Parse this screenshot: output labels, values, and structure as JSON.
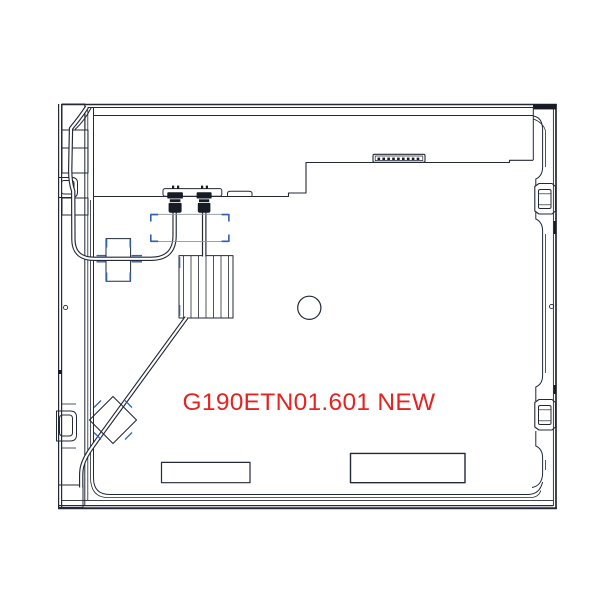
{
  "drawing": {
    "kind": "lcd-panel-rear-view-technical-drawing",
    "label": "G190ETN01.601 NEW",
    "label_color": "#e52421",
    "line_color": "#232936",
    "fill_dark": "#161b24",
    "accent_blue": "#2f5fb3",
    "muted_line": "#8d939e",
    "background": "#ffffff"
  }
}
